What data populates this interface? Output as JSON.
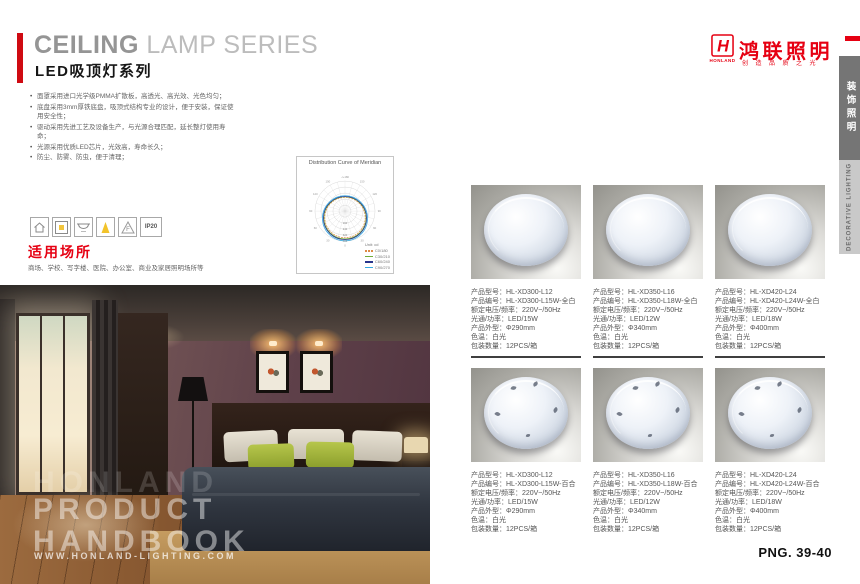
{
  "colors": {
    "accent_red": "#e60012",
    "divider_dark": "#3f3f3f",
    "spec_text": "#555555"
  },
  "left_page": {
    "title_en_strong": "CEILING",
    "title_en_light": " LAMP SERIES",
    "title_cn": "LED吸顶灯系列",
    "features": [
      "面罩采用进口光学级PMMA扩散板，高透光、高光效、光色均匀；",
      "底盘采用3mm厚铁底盘，吸顶式结构专业的设计，便于安装，保证使用安全性；",
      "驱动采用先进工艺及设备生产，与光源合理匹配，延长整灯使用寿命；",
      "光源采用优质LED芯片，光效高，寿命长久；",
      "防尘、防雾、防虫，便于清理；"
    ],
    "curve_box": {
      "title": "Distribution Curve of Meridian",
      "unit_label": "Unit: cd",
      "angle_labels": [
        "-/+180",
        "150",
        "120",
        "90",
        "60",
        "30",
        "0"
      ],
      "ring_labels": [
        "160",
        "240",
        "320",
        "400"
      ],
      "legend": [
        {
          "label": "C0/180",
          "color": "#dd8a45",
          "dash": "2 1"
        },
        {
          "label": "C30/210",
          "color": "#6fae3a",
          "dash": ""
        },
        {
          "label": "C60/240",
          "color": "#27348b",
          "dash": ""
        },
        {
          "label": "C90/270",
          "color": "#36a9e1",
          "dash": ""
        }
      ],
      "series": [
        {
          "name": "C0/180",
          "radius": 21.5
        },
        {
          "name": "C30/210",
          "radius": 22.5
        },
        {
          "name": "C60/240",
          "radius": 23
        },
        {
          "name": "C90/270",
          "radius": 24
        }
      ]
    },
    "cert_icons": {
      "f_mark": "F",
      "ip_rating": "IP20"
    },
    "usage": {
      "title": "适用场所",
      "text": "商场、学校、写字楼、医院、办公室、商业及家居照明场所等"
    },
    "photo_overlay": {
      "ghost": "HONLAND",
      "line1": "PRODUCT",
      "line2": "HANDBOOK",
      "website": "WWW.HONLAND-LIGHTING.COM"
    }
  },
  "right_page": {
    "brand": {
      "logo_letter": "H",
      "logo_word": "HONLAND",
      "name_cn": "鸿联照明",
      "slogan_cn": "创造品质之光"
    },
    "side_tabs": [
      {
        "label": "装饰照明"
      },
      {
        "label": "DECORATIVE LIGHTING"
      }
    ],
    "products": [
      {
        "variant": "plain",
        "specs": [
          "产品型号：HL-XD300-L12",
          "产品编号：HL-XD300-L15W-全白",
          "额定电压/频率：220V~/50Hz",
          "光通/功率：LED/15W",
          "产品外型：Φ290mm",
          "色温：白光",
          "包装数量：12PCS/箱"
        ]
      },
      {
        "variant": "plain",
        "specs": [
          "产品型号：HL-XD350-L16",
          "产品编号：HL-XD350-L18W-全白",
          "额定电压/频率：220V~/50Hz",
          "光通/功率：LED/12W",
          "产品外型：Φ340mm",
          "色温：白光",
          "包装数量：12PCS/箱"
        ]
      },
      {
        "variant": "plain",
        "specs": [
          "产品型号：HL-XD420-L24",
          "产品编号：HL-XD420-L24W-全白",
          "额定电压/频率：220V~/50Hz",
          "光通/功率：LED/18W",
          "产品外型：Φ400mm",
          "色温：白光",
          "包装数量：12PCS/箱"
        ]
      },
      {
        "variant": "lily",
        "specs": [
          "产品型号：HL-XD300-L12",
          "产品编号：HL-XD300-L15W-百合",
          "额定电压/频率：220V~/50Hz",
          "光通/功率：LED/15W",
          "产品外型：Φ290mm",
          "色温：白光",
          "包装数量：12PCS/箱"
        ]
      },
      {
        "variant": "lily",
        "specs": [
          "产品型号：HL-XD350-L16",
          "产品编号：HL-XD350-L18W-百合",
          "额定电压/频率：220V~/50Hz",
          "光通/功率：LED/12W",
          "产品外型：Φ340mm",
          "色温：白光",
          "包装数量：12PCS/箱"
        ]
      },
      {
        "variant": "lily",
        "specs": [
          "产品型号：HL-XD420-L24",
          "产品编号：HL-XD420-L24W-百合",
          "额定电压/频率：220V~/50Hz",
          "光通/功率：LED/18W",
          "产品外型：Φ400mm",
          "色温：白光",
          "包装数量：12PCS/箱"
        ]
      }
    ],
    "page_number": "PNG. 39-40"
  }
}
